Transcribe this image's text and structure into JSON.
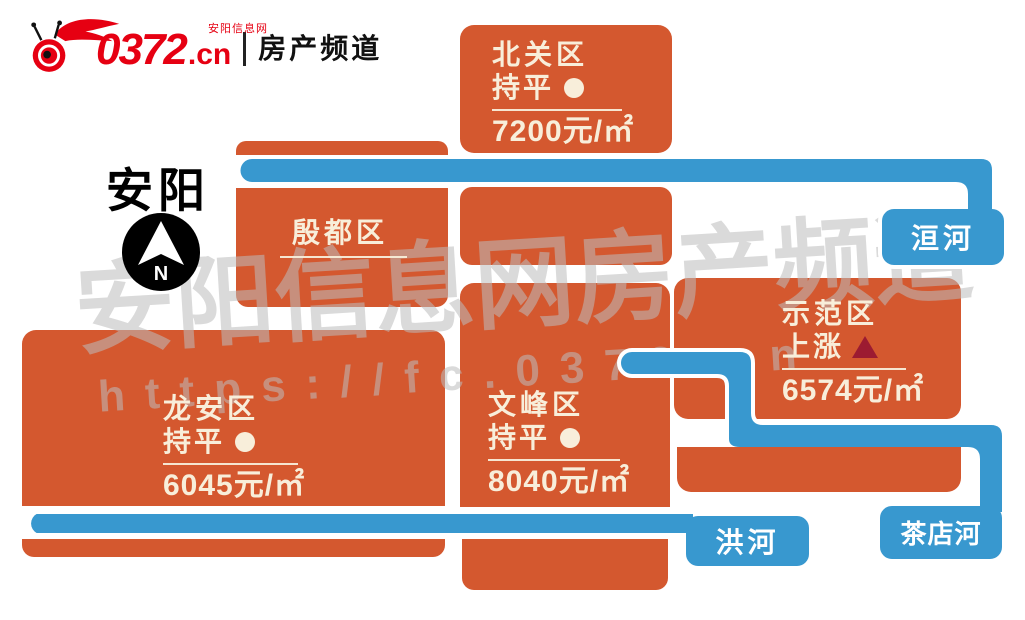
{
  "header": {
    "logo_number": "0372",
    "logo_domain": ".cn",
    "logo_subtitle": "安阳信息网",
    "logo_channel": "房产频道"
  },
  "map": {
    "city_label": "安阳",
    "compass_letter": "N",
    "districts": [
      {
        "id": "beiguan",
        "name": "北关区",
        "trend": "持平",
        "trend_type": "flat",
        "price": "7200元/㎡"
      },
      {
        "id": "yindu",
        "name": "殷都区"
      },
      {
        "id": "longan",
        "name": "龙安区",
        "trend": "持平",
        "trend_type": "flat",
        "price": "6045元/㎡"
      },
      {
        "id": "wenfeng",
        "name": "文峰区",
        "trend": "持平",
        "trend_type": "flat",
        "price": "8040元/㎡"
      },
      {
        "id": "shifan",
        "name": "示范区",
        "trend": "上涨",
        "trend_type": "rise",
        "price": "6574元/㎡"
      }
    ],
    "rivers": [
      {
        "id": "huan",
        "name": "洹河"
      },
      {
        "id": "hong",
        "name": "洪河"
      },
      {
        "id": "chadian",
        "name": "茶店河"
      }
    ]
  },
  "watermark": {
    "line1": "安阳信息网房产频道",
    "line2": "https://fc.0372.cn"
  },
  "colors": {
    "block_orange": "#d4582f",
    "river_blue": "#3898cf",
    "text_cream": "#f8eeda",
    "rise_red": "#9c1b31",
    "logo_red": "#e60012"
  }
}
